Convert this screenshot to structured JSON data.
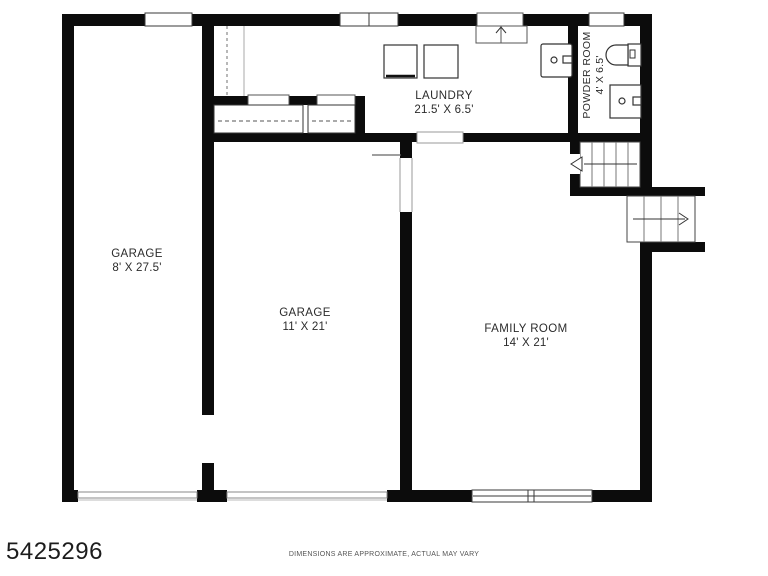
{
  "floor_plan": {
    "rooms": [
      {
        "name": "GARAGE",
        "dims": "8' X 27.5'"
      },
      {
        "name": "GARAGE",
        "dims": "11' X 21'"
      },
      {
        "name": "FAMILY ROOM",
        "dims": "14' X 21'"
      },
      {
        "name": "LAUNDRY",
        "dims": "21.5' X 6.5'"
      },
      {
        "name": "POWDER ROOM",
        "dims": "4' X 6.5'"
      }
    ],
    "fixtures": [
      "washer",
      "dryer",
      "laundry-sink",
      "toilet",
      "vanity-sink",
      "closet",
      "closet",
      "interior-stairs",
      "exterior-stairs",
      "entry-door"
    ],
    "colors": {
      "wall": "#0c0c0c",
      "background": "#ffffff",
      "fixture_line": "#333333",
      "light_line": "#888888",
      "text": "#2b2b2b"
    }
  },
  "footer": {
    "listing_id": "5425296",
    "disclaimer": "DIMENSIONS ARE APPROXIMATE, ACTUAL MAY VARY"
  }
}
